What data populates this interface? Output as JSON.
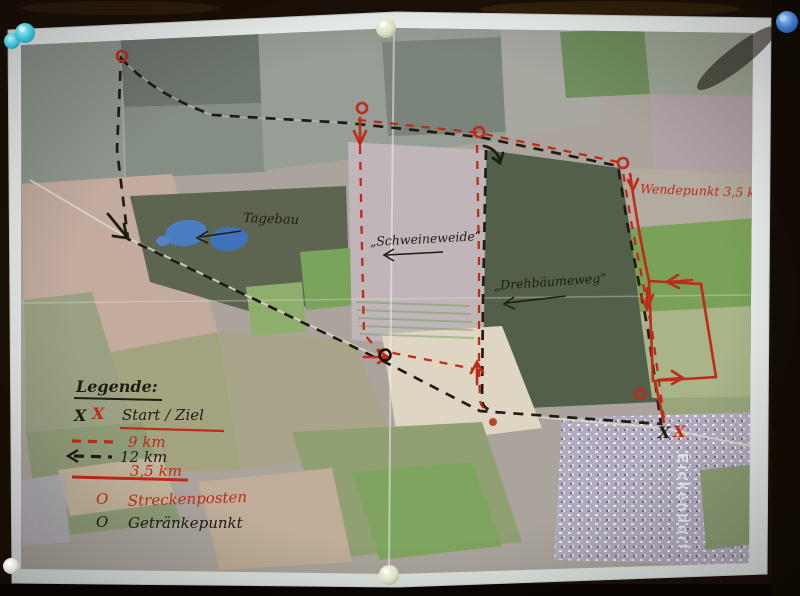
{
  "photo_map": {
    "description": "Aerial race-course map pinned to a dark board",
    "place_labels": {
      "tagebau": "Tagebau",
      "schweineweide": "„Schweineweide“",
      "drehbaeumeweg": "„Drehbäumeweg“",
      "eickendorf": "Eickendorf"
    },
    "route_notes": {
      "wendepunkt": "Wendepunkt 3,5 km",
      "start_x_black": "X",
      "start_x_red": "X"
    },
    "legend": {
      "title": "Legende:",
      "start_symbol_black": "X",
      "start_symbol_red": "X",
      "start_label": "Start / Ziel",
      "route_9km_label": "9 km",
      "route_12km_label": "12 km",
      "route_35km_label": "3,5 km",
      "streckenposten_symbol": "O",
      "streckenposten_label": "Streckenposten",
      "getraenkepunkt_symbol": "O",
      "getraenkepunkt_label": "Getränkepunkt"
    },
    "colors": {
      "route_red": "#c02a18",
      "route_black": "#211b12",
      "lake_blue": "#4b7dc3"
    }
  }
}
